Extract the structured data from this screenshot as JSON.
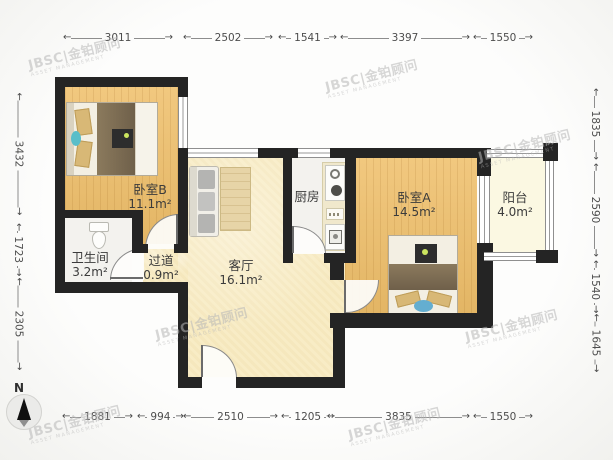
{
  "plan": {
    "rooms": [
      {
        "name": "卧室B",
        "area": "11.1m²"
      },
      {
        "name": "卫生间",
        "area": "3.2m²"
      },
      {
        "name": "过道",
        "area": "0.9m²"
      },
      {
        "name": "客厅",
        "area": "16.1m²"
      },
      {
        "name": "厨房",
        "area": ""
      },
      {
        "name": "卧室A",
        "area": "14.5m²"
      },
      {
        "name": "阳台",
        "area": "4.0m²"
      }
    ],
    "dimensions": {
      "top": [
        "3011",
        "2502",
        "1541",
        "3397",
        "1550"
      ],
      "bottom": [
        "1881",
        "994",
        "2510",
        "1205",
        "3835",
        "1550"
      ],
      "left": [
        "3432",
        "1723",
        "2305"
      ],
      "right": [
        "1835",
        "2590",
        "1540",
        "1645"
      ]
    },
    "compass": {
      "label": "N"
    },
    "watermark": {
      "text": "JBSC|金铂顾问",
      "subtitle": "ASSET MANAGEMENT"
    },
    "colors": {
      "wall": "#242424",
      "wood_floor": "#efbf6a",
      "living_floor": "#f8ecc5",
      "wet_floor": "#f3f2ee",
      "balcony_floor": "#fbf8e2",
      "watermark": "#b7b7b7"
    }
  }
}
